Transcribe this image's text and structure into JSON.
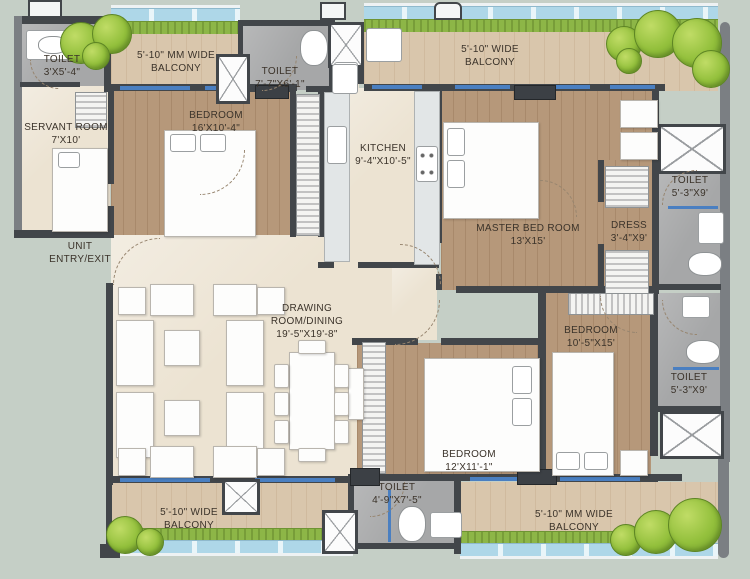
{
  "plan_type": "apartment-floor-plan",
  "colors": {
    "background": "#c5cfc6",
    "wall_dark": "#42464a",
    "wall_light": "#7b7f83",
    "wood_floor": "#b6987a",
    "balcony_floor": "#d9c6ac",
    "marble_floor": "#ece3d2",
    "toilet_floor": "#a6a7a8",
    "plant_strip": "#8db647",
    "glass_blue": "#aed7e8",
    "window_blue": "#4a7fc1",
    "tree_green": "#93c03c",
    "label_text": "#3b332a"
  },
  "rooms": {
    "toilet_servant": {
      "name": "TOILET",
      "dims": "3'X5'-4\""
    },
    "balcony_top_left": {
      "line1": "5'-10\" MM WIDE",
      "line2": "BALCONY"
    },
    "servant_room": {
      "name": "SERVANT ROOM",
      "dims": "7'X10'"
    },
    "bedroom_1": {
      "name": "BEDROOM",
      "dims": "16'X10'-4\""
    },
    "toilet_common": {
      "name": "TOILET",
      "dims": "7'-7\"X6'-1\""
    },
    "kitchen": {
      "name": "KITCHEN",
      "dims": "9'-4\"X10'-5\""
    },
    "balcony_top_right": {
      "line1": "5'-10\" WIDE",
      "line2": "BALCONY"
    },
    "master_bedroom": {
      "name": "MASTER BED ROOM",
      "dims": "13'X15'"
    },
    "dress": {
      "name": "DRESS",
      "dims": "3'-4\"X9'"
    },
    "toilet_master": {
      "name": "TOILET",
      "dims": "5'-3\"X9'"
    },
    "unit_entry": {
      "line1": "UNIT",
      "line2": "ENTRY/EXIT"
    },
    "drawing_room": {
      "line1": "DRAWING",
      "line2": "ROOM/DINING",
      "dims": "19'-5\"X19'-8\""
    },
    "bedroom_2": {
      "name": "BEDROOM",
      "dims": "10'-5\"X15'"
    },
    "toilet_bedroom_2": {
      "name": "TOILET",
      "dims": "5'-3\"X9'"
    },
    "bedroom_3": {
      "name": "BEDROOM",
      "dims": "12'X11'-1\""
    },
    "toilet_bedroom_3": {
      "name": "TOILET",
      "dims": "4'-9\"X7'-5\""
    },
    "balcony_bottom_left": {
      "line1": "5'-10\" WIDE",
      "line2": "BALCONY"
    },
    "balcony_bottom_right": {
      "line1": "5'-10\" MM WIDE",
      "line2": "BALCONY"
    }
  }
}
